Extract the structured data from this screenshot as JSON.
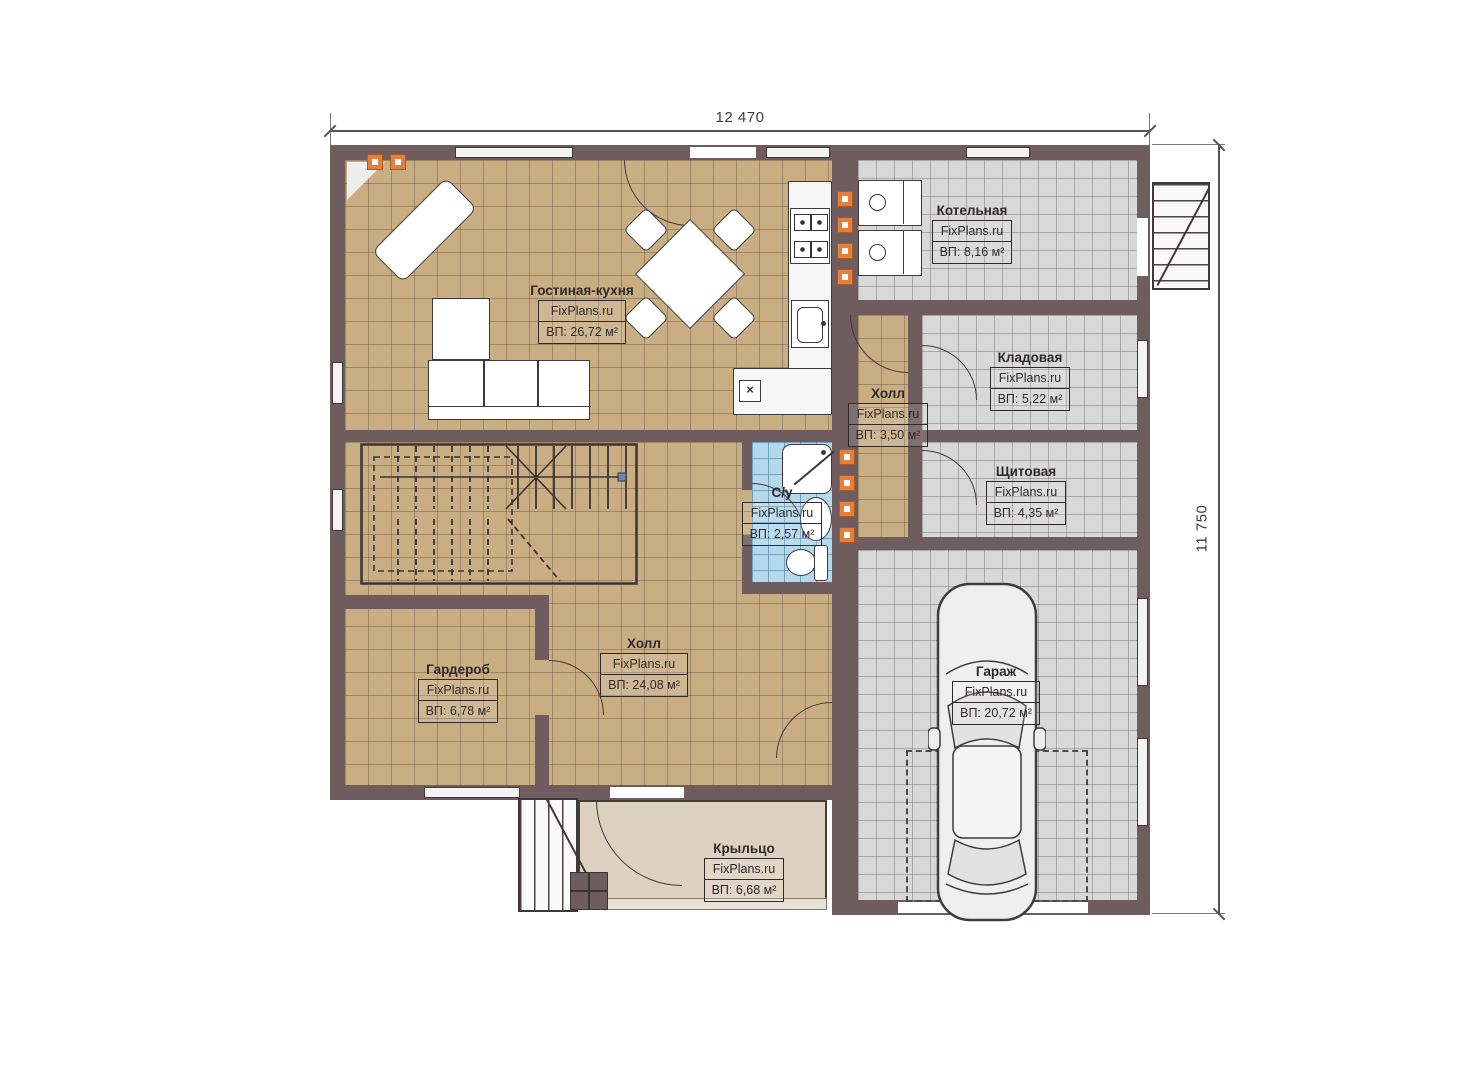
{
  "plan": {
    "dimensions": {
      "width_total": "12 470",
      "height_total": "11 750"
    },
    "rooms": [
      {
        "name": "Гостиная-кухня",
        "brand": "FixPlans.ru",
        "area": "ВП: 26,72 м²"
      },
      {
        "name": "Котельная",
        "brand": "FixPlans.ru",
        "area": "ВП: 8,16 м²"
      },
      {
        "name": "Кладовая",
        "brand": "FixPlans.ru",
        "area": "ВП: 5,22 м²"
      },
      {
        "name": "Щитовая",
        "brand": "FixPlans.ru",
        "area": "ВП: 4,35 м²"
      },
      {
        "name": "Холл",
        "brand": "FixPlans.ru",
        "area": "ВП: 3,50 м²"
      },
      {
        "name": "С/у",
        "brand": "FixPlans.ru",
        "area": "ВП: 2,57 м²"
      },
      {
        "name": "Холл",
        "brand": "FixPlans.ru",
        "area": "ВП: 24,08 м²"
      },
      {
        "name": "Гардероб",
        "brand": "FixPlans.ru",
        "area": "ВП: 6,78 м²"
      },
      {
        "name": "Гараж",
        "brand": "FixPlans.ru",
        "area": "ВП: 20,72 м²"
      },
      {
        "name": "Крыльцо",
        "brand": "FixPlans.ru",
        "area": "ВП: 6,68 м²"
      }
    ],
    "symbols": {
      "sink_cross": "×"
    },
    "colors": {
      "wall": "#6f5c5e",
      "floor_tan": "#c9ae84",
      "floor_gray": "#d8d8d8",
      "floor_blue": "#b4d8ec",
      "floor_porch": "#ddd1c0",
      "marker_orange": "#e5803c"
    }
  }
}
